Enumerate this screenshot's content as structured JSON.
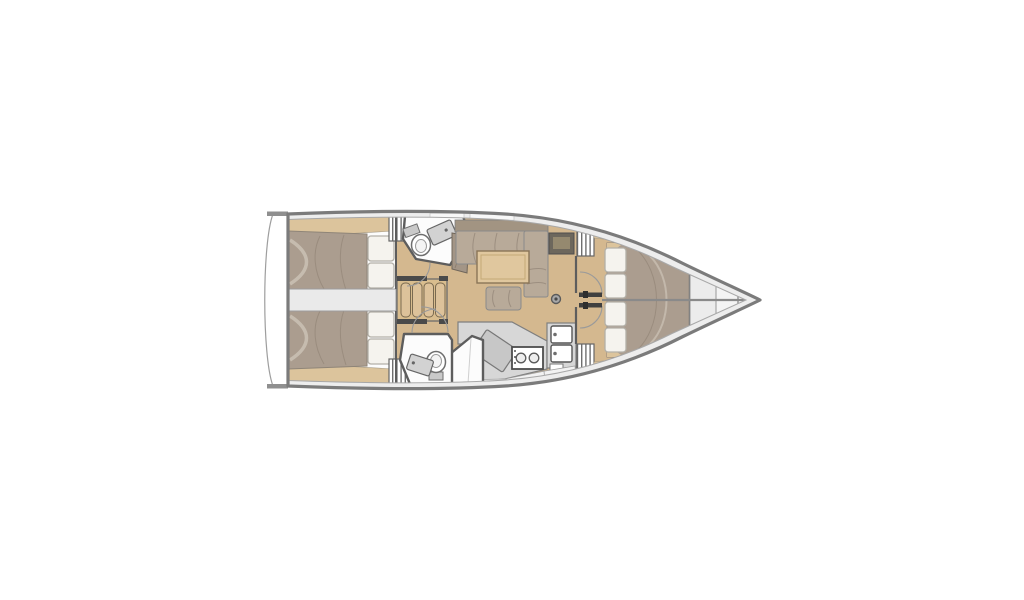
{
  "figure": {
    "kind": "sailboat-interior-floor-plan",
    "view": "top-down",
    "bow_direction": "right"
  },
  "areas": {
    "transom": "swim-platform",
    "aft_cabin_port": "aft-double-cabin-port",
    "aft_cabin_starboard": "aft-double-cabin-starboard",
    "engine_compartment": "engine-compartment",
    "companionway": "companionway-steps",
    "head_port": "port-head-toilet-sink",
    "head_starboard": "starboard-head-toilet-sink-shower",
    "saloon": "saloon-l-settee-table-stool",
    "galley": "galley-stove-double-sink",
    "forward_cabin": "forward-v-berth-cabin",
    "bow_locker": "bow-anchor-locker",
    "mast": "mast-post"
  },
  "colors": {
    "background": "#ffffff",
    "hull-stroke": "#7b7b7b",
    "deck": "#ededed",
    "deck-stroke": "#a8a8a8",
    "wall": "#5d5d5d",
    "wood-floor": "#d4b88f",
    "wood-trim": "#dcc49c",
    "step-wood": "#d9bd8e",
    "mattress": "#ab9d8f",
    "mattress-stroke": "#8f8578",
    "mattress-shade": "#97897b",
    "pillow": "#f5f3ee",
    "pillow-stroke": "#b3b0a8",
    "counter": "#d7d7d7",
    "counter-stroke": "#7f7f7f",
    "fixture-stroke": "#6e6e6e",
    "cabinet-dark": "#6d675c",
    "cabinet-inset": "#95896f",
    "engine": "#eaeaea",
    "hatch-stroke": "#666666",
    "door-leaf": "#3f3f3f",
    "arc-stroke": "#9a9a9a"
  }
}
